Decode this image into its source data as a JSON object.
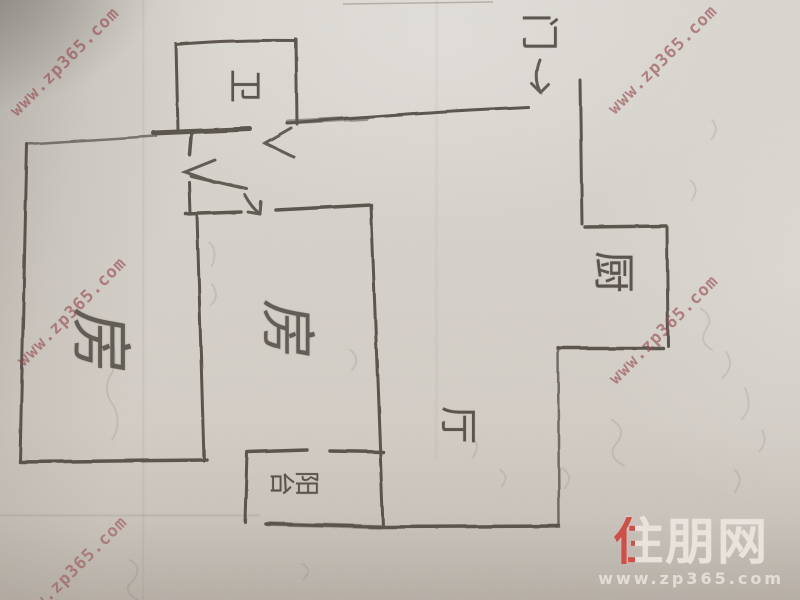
{
  "floor_plan": {
    "rooms": [
      {
        "name": "bedroom-left",
        "label": "房"
      },
      {
        "name": "bedroom-middle",
        "label": "房"
      },
      {
        "name": "bathroom",
        "label": "卫"
      },
      {
        "name": "kitchen",
        "label": "厨"
      },
      {
        "name": "living-room",
        "label": "厅"
      },
      {
        "name": "balcony",
        "label": "阳台"
      },
      {
        "name": "entry-door",
        "label": "门"
      }
    ],
    "pencil_color": "#46413a"
  },
  "watermark": {
    "text": "www.zp365.com",
    "color": "#964a4f"
  },
  "logo": {
    "brand": "住朋网",
    "brand_chars": [
      "住",
      "朋",
      "网"
    ],
    "url": "www.zp365.com",
    "accent_color": "#cf463e",
    "text_color": "#ece7e0"
  }
}
